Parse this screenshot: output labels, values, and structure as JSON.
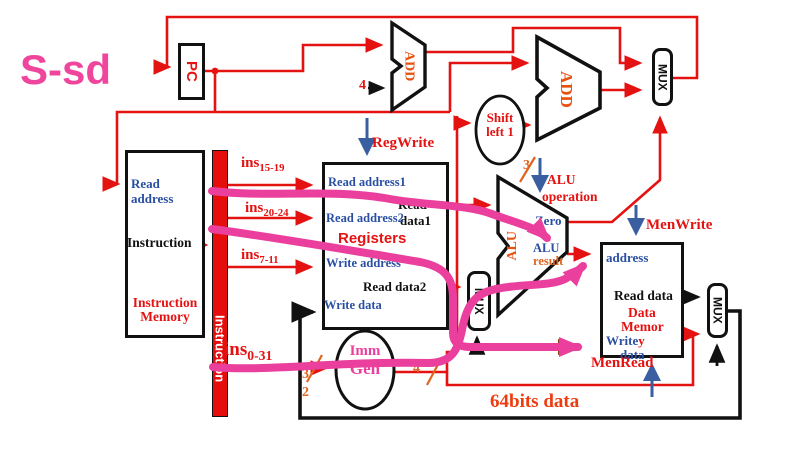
{
  "title": "S-sd",
  "colors": {
    "wire_red": "#e51212",
    "highlight_pink": "#ea3f9d",
    "label_blue": "#2a4fa2",
    "bus_orange": "#e0641e",
    "block_orange": "#e8500f",
    "brown_wire": "#8a3c10",
    "black": "#111111"
  },
  "pc": {
    "label": "PC"
  },
  "instruction_memory": {
    "read_address_line1": "Read",
    "read_address_line2": "address",
    "output_label": "Instruction",
    "name_line1": "Instruction",
    "name_line2": "Memory"
  },
  "instruction_bar": {
    "label": "Instruction"
  },
  "ins_fields": [
    {
      "base": "ins",
      "sub": "15-19"
    },
    {
      "base": "ins",
      "sub": "20-24"
    },
    {
      "base": "ins",
      "sub": "7-11"
    },
    {
      "base": "ins",
      "sub": "0-31"
    }
  ],
  "adders": {
    "add1_label": "ADD",
    "add2_label": "ADD"
  },
  "shift_left": {
    "line1": "Shift",
    "line2": "left 1"
  },
  "muxes": {
    "mux_top": "MUX",
    "mux_mid": "MUX",
    "mux_right": "MUX"
  },
  "registers": {
    "read_address1": "Read address1",
    "read_data1_line1": "Read",
    "read_data1_line2": "data1",
    "read_address2": "Read address2",
    "title": "Registers",
    "write_address": "Write address",
    "read_data2": "Read data2",
    "write_data": "Write data"
  },
  "imm_gen": {
    "line1": "Imm",
    "line2": "Gen"
  },
  "alu": {
    "label": "ALU",
    "zero": "Zero",
    "result_line1": "ALU",
    "result_line2": "result"
  },
  "data_memory": {
    "address": "address",
    "read_data": "Read data",
    "name_line1": "Data",
    "name_line2": "Memor",
    "write_label": "Write",
    "write_y": "y",
    "write_data2": "data"
  },
  "signals": {
    "reg_write": "RegWrite",
    "alu_op_line1": "ALU",
    "alu_op_line2": "operation",
    "men_write": "MenWrite",
    "men_read": "MenRead"
  },
  "bus_widths": {
    "pc_increment": "4",
    "alu_op_bits": "3",
    "imm_in_hi": "3",
    "imm_in_lo": "2",
    "imm_out": "4"
  },
  "notes": {
    "bits_caption": "64bits data"
  }
}
